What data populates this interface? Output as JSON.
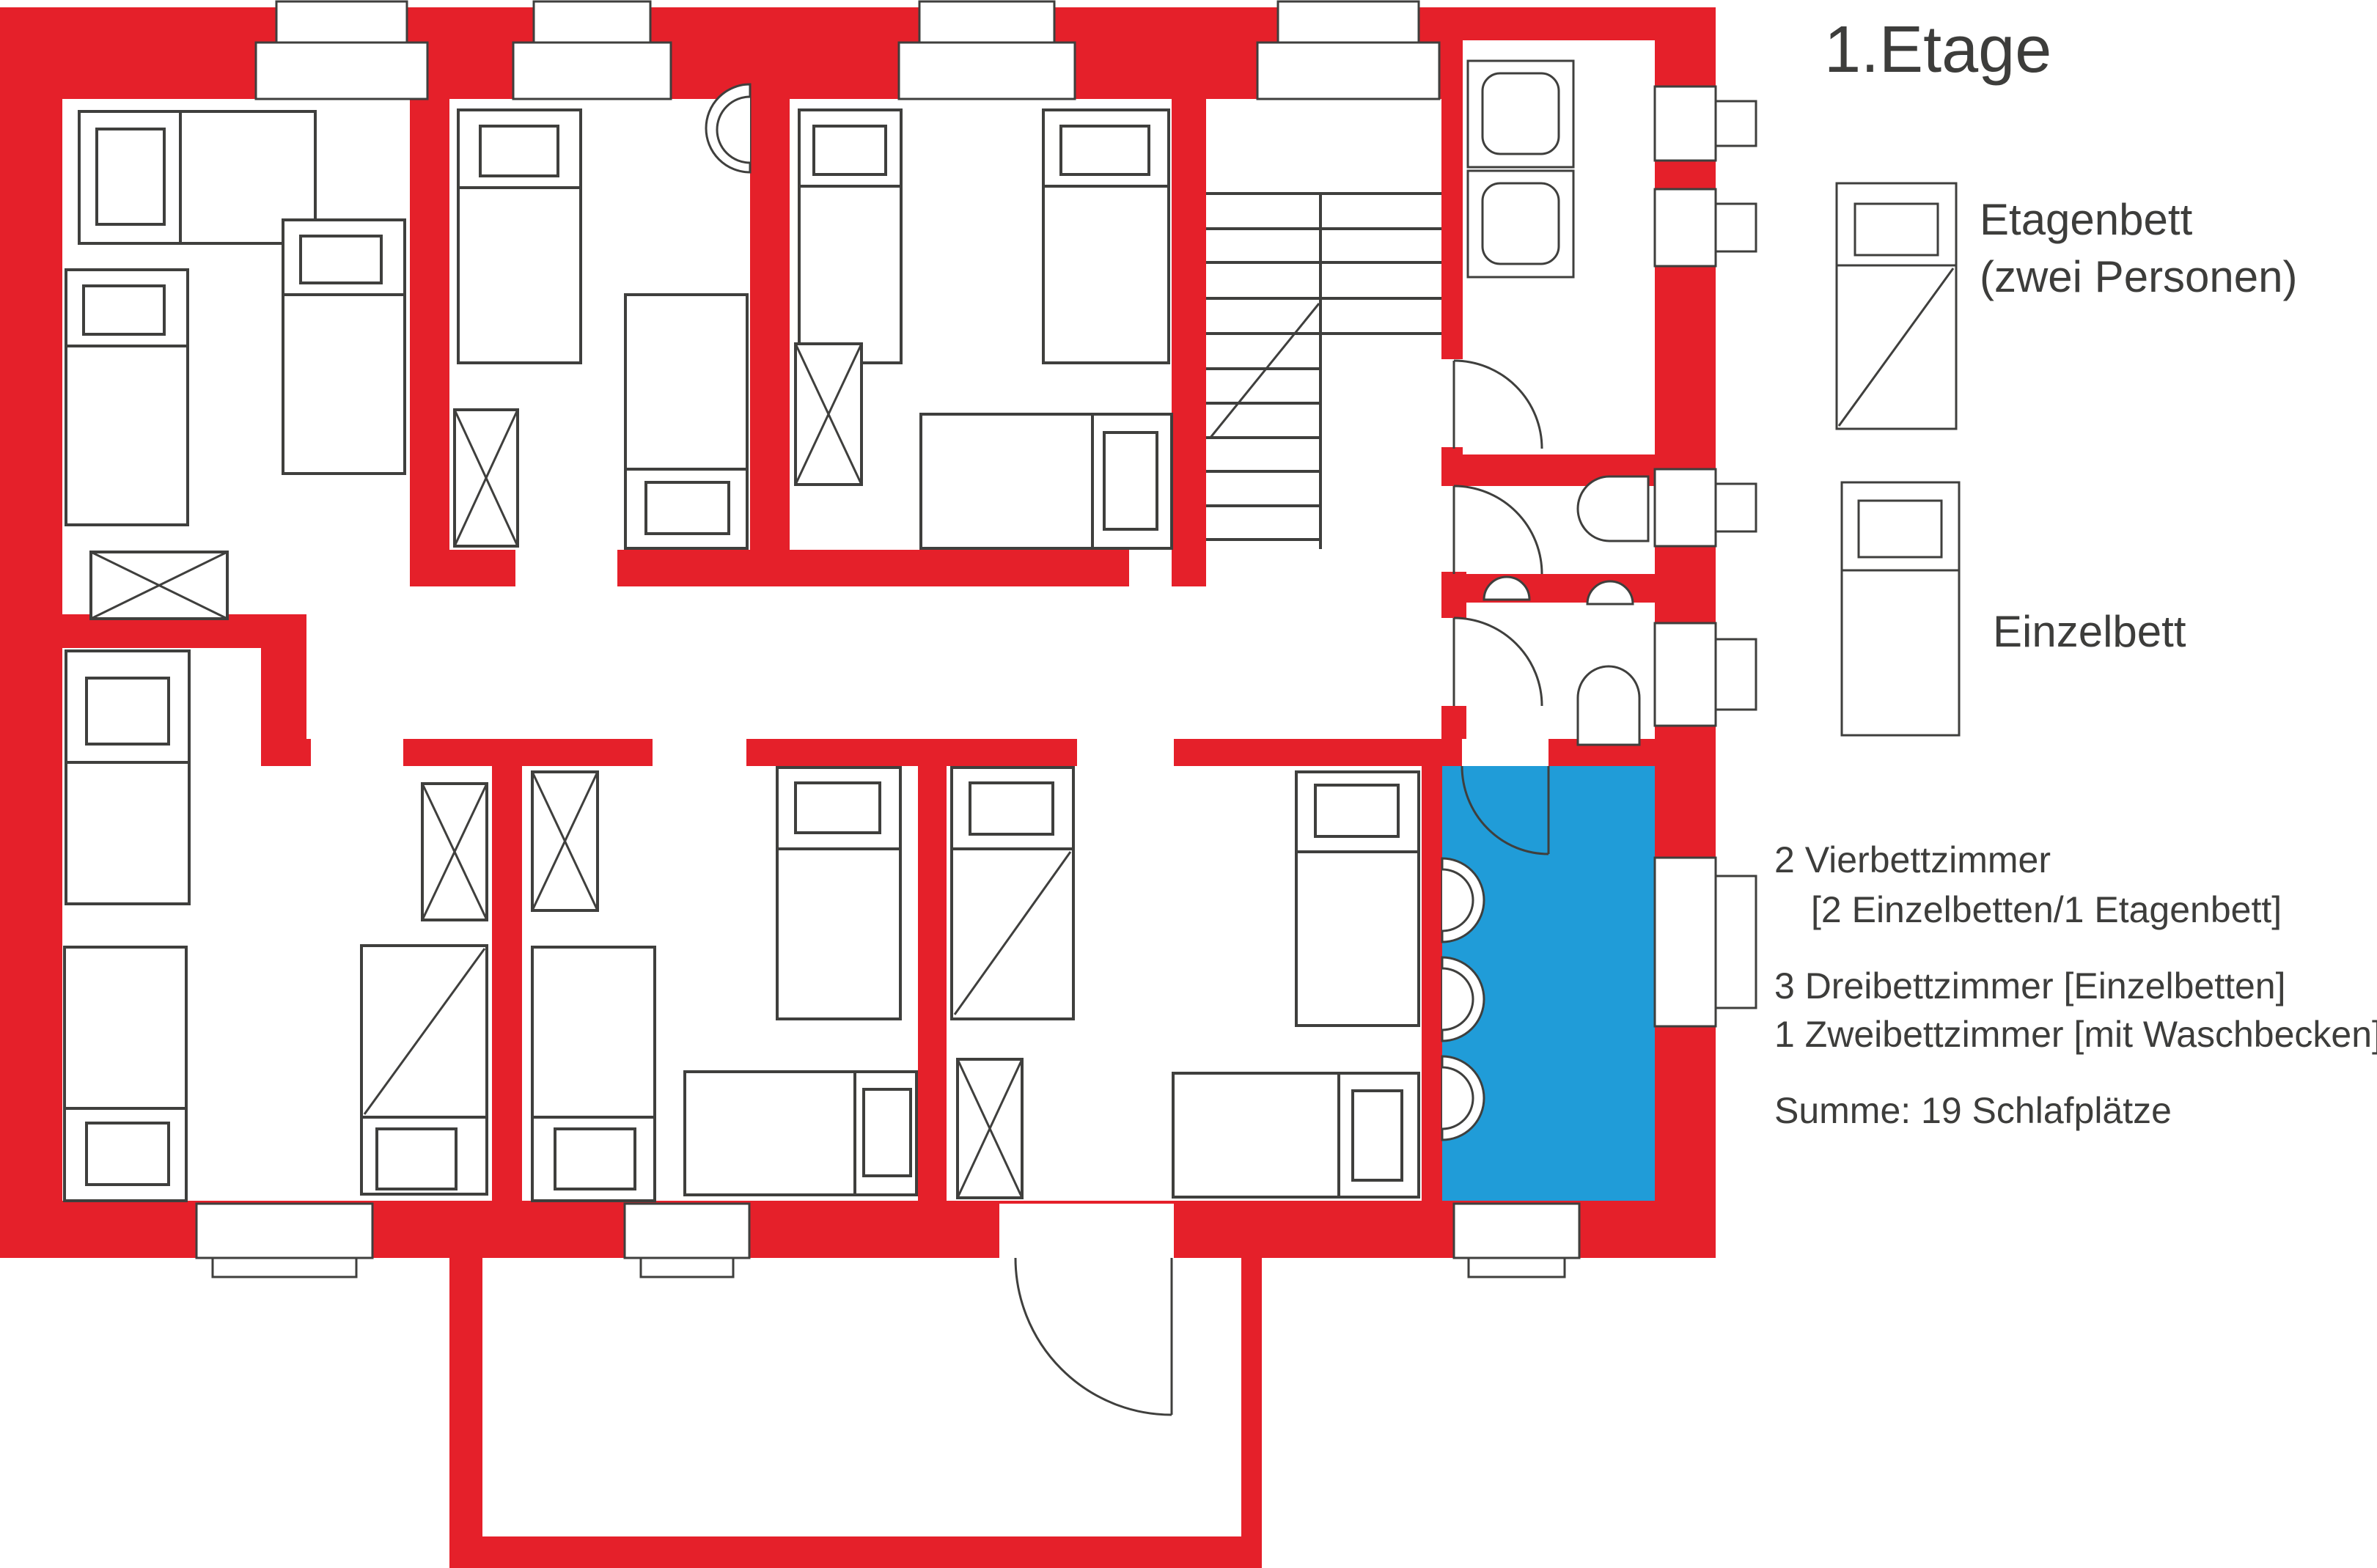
{
  "title": "1.Etage",
  "legend": {
    "etagenbett": {
      "symbol": "bunk-bed-icon",
      "line1": "Etagenbett",
      "line2": "(zwei Personen)"
    },
    "einzelbett": {
      "symbol": "single-bed-icon",
      "label": "Einzelbett"
    }
  },
  "info": {
    "line1": "2 Vierbettzimmer",
    "line2": "[2 Einzelbetten/1 Etagenbett]",
    "line3": "3 Dreibettzimmer  [Einzelbetten]",
    "line4": "1 Zweibettzimmer [mit Waschbecken]",
    "summary": "Summe: 19 Schlafplätze"
  },
  "colors": {
    "wall_red": "#e5202a",
    "highlight_blue": "#209cd8",
    "line_gray": "#3f3f3d",
    "text_gray": "#3d3d3b"
  },
  "rooms": {
    "highlighted_room": "Waschraum (blau markiert)",
    "bed_total": "19"
  }
}
